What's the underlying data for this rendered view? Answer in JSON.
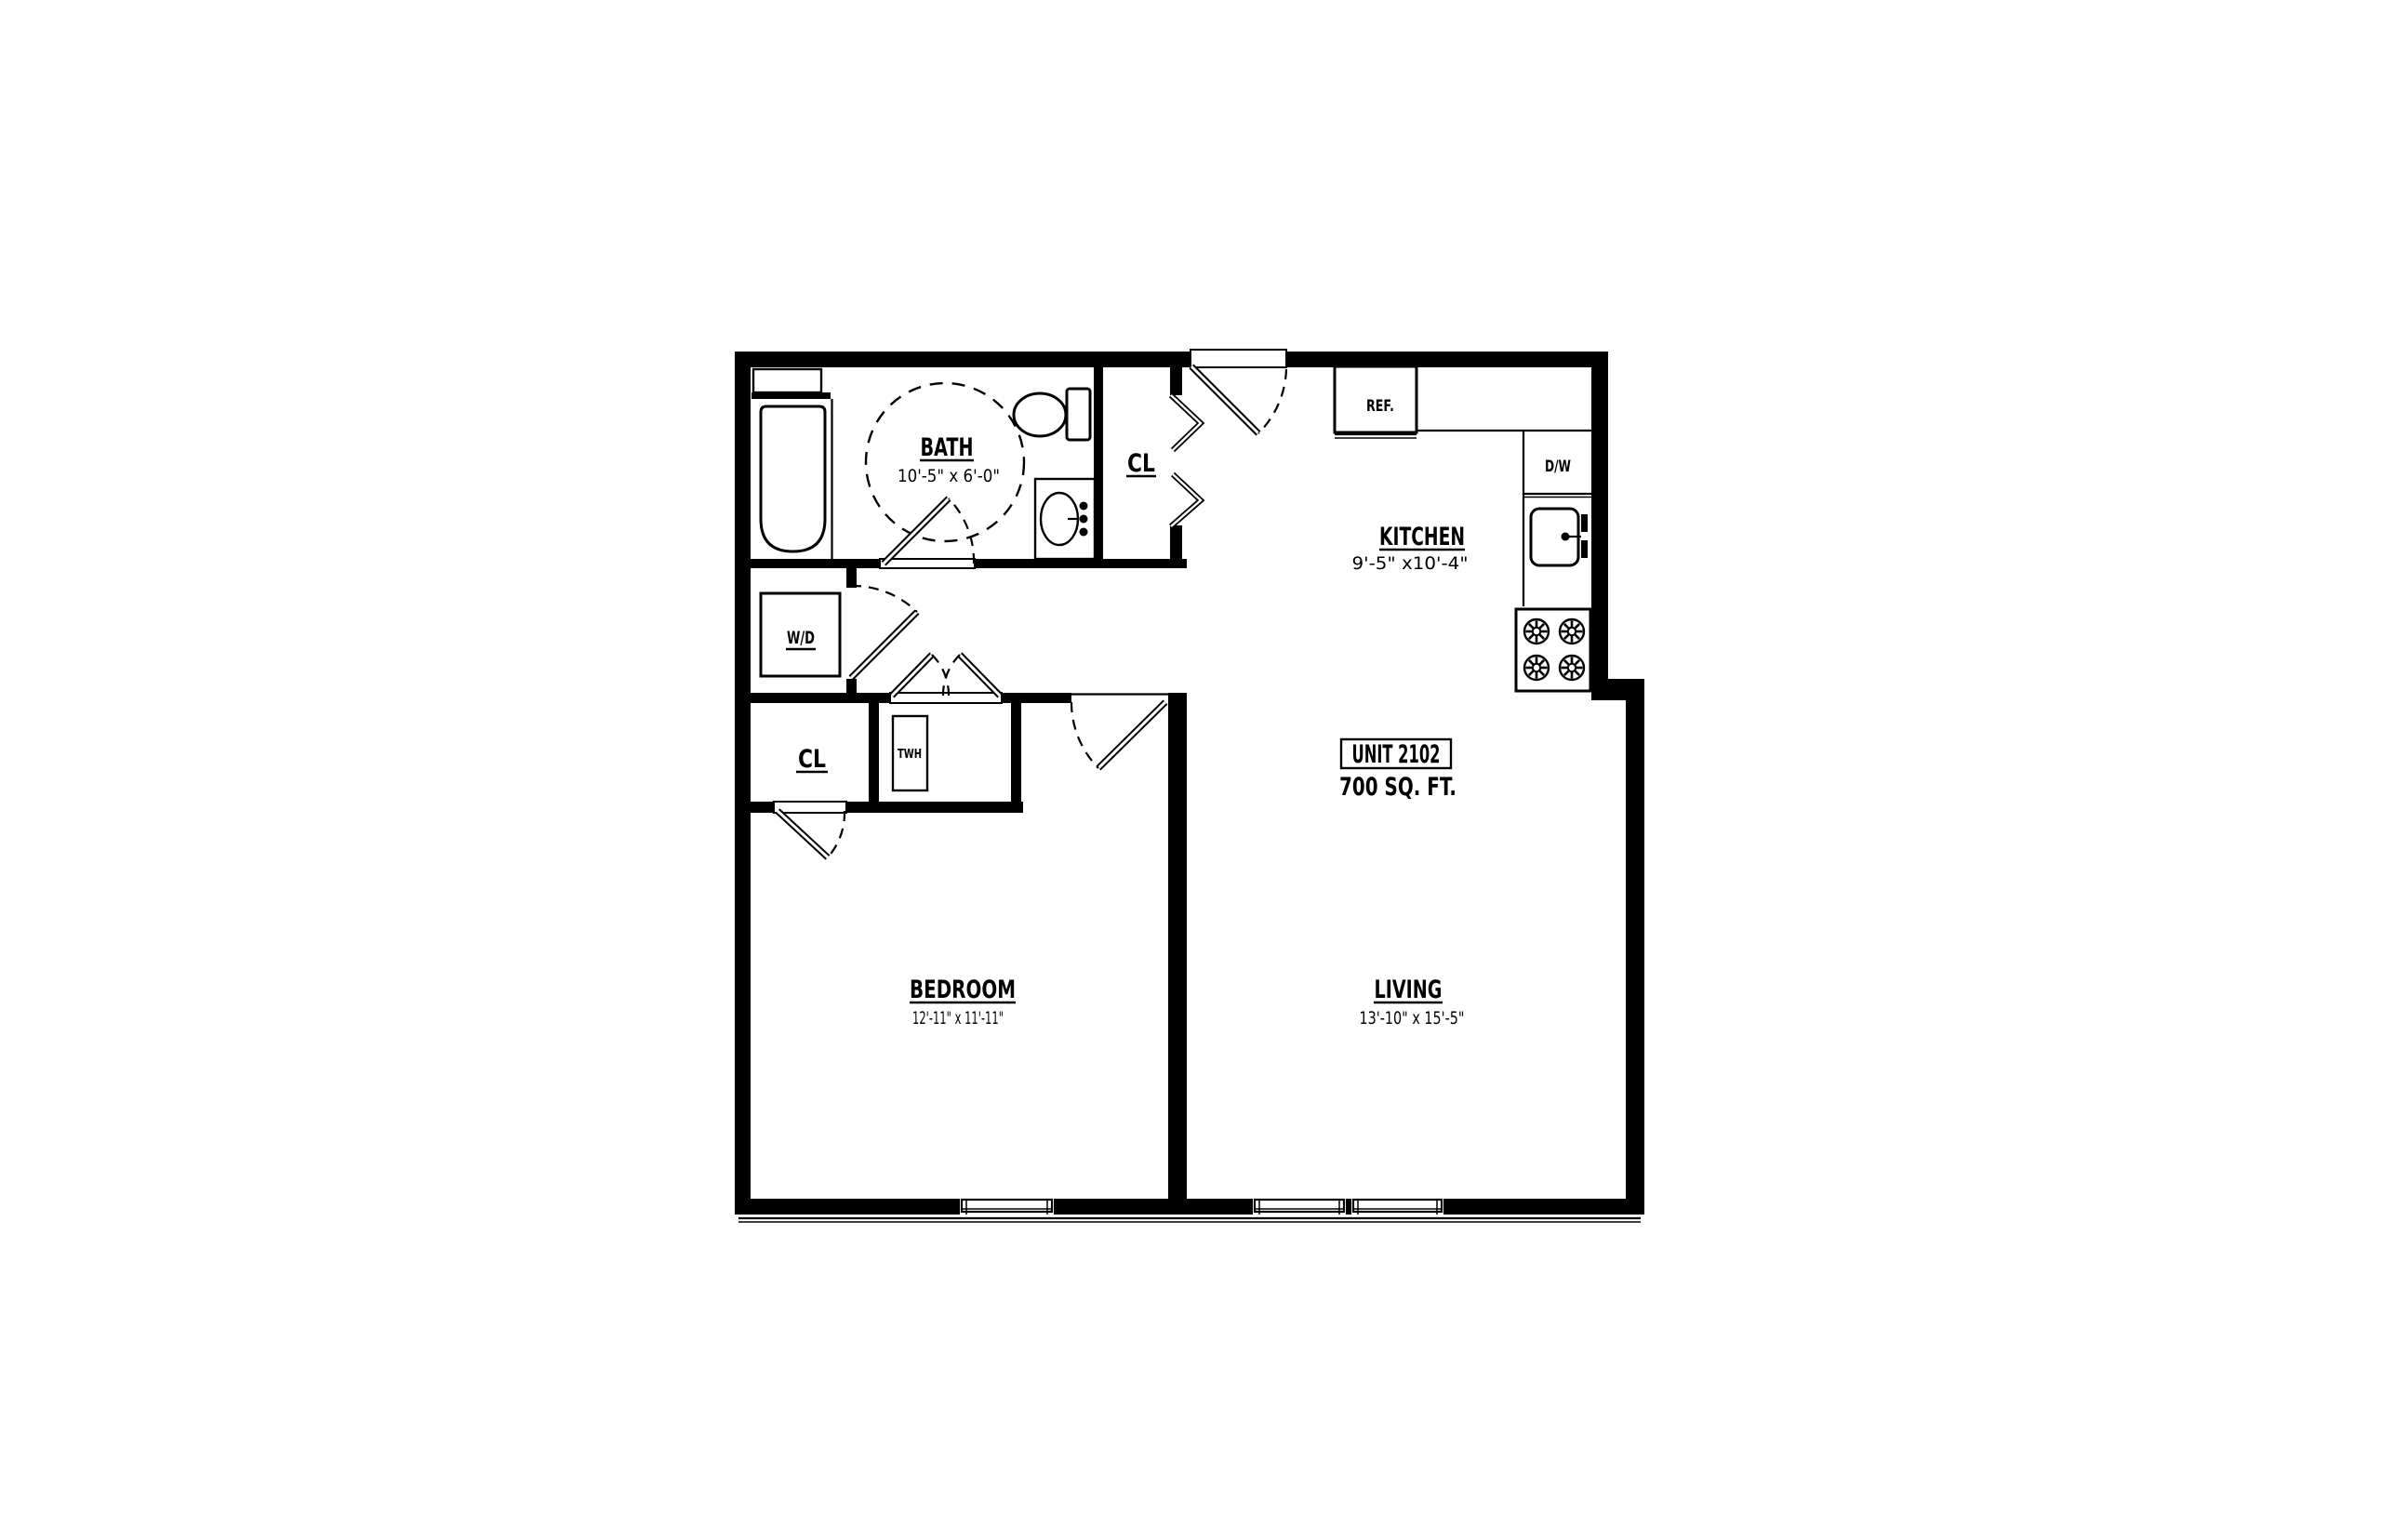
{
  "floorplan": {
    "unit": {
      "label": "UNIT 2102",
      "area": "700 SQ. FT."
    },
    "rooms": {
      "bath": {
        "name": "BATH",
        "dims": "10'-5\" x 6'-0\""
      },
      "kitchen": {
        "name": "KITCHEN",
        "dims": "9'-5\" x10'-4\""
      },
      "bedroom": {
        "name": "BEDROOM",
        "dims": "12'-11\" x 11'-11\""
      },
      "living": {
        "name": "LIVING",
        "dims": "13'-10\" x 15'-5\""
      }
    },
    "closets": {
      "entry_closet": "CL",
      "bedroom_closet": "CL"
    },
    "appliances": {
      "washer_dryer": "W/D",
      "water_heater": "TWH",
      "refrigerator": "REF.",
      "dishwasher": "D/W"
    },
    "colors": {
      "walls": "#000000",
      "background": "#ffffff"
    }
  }
}
